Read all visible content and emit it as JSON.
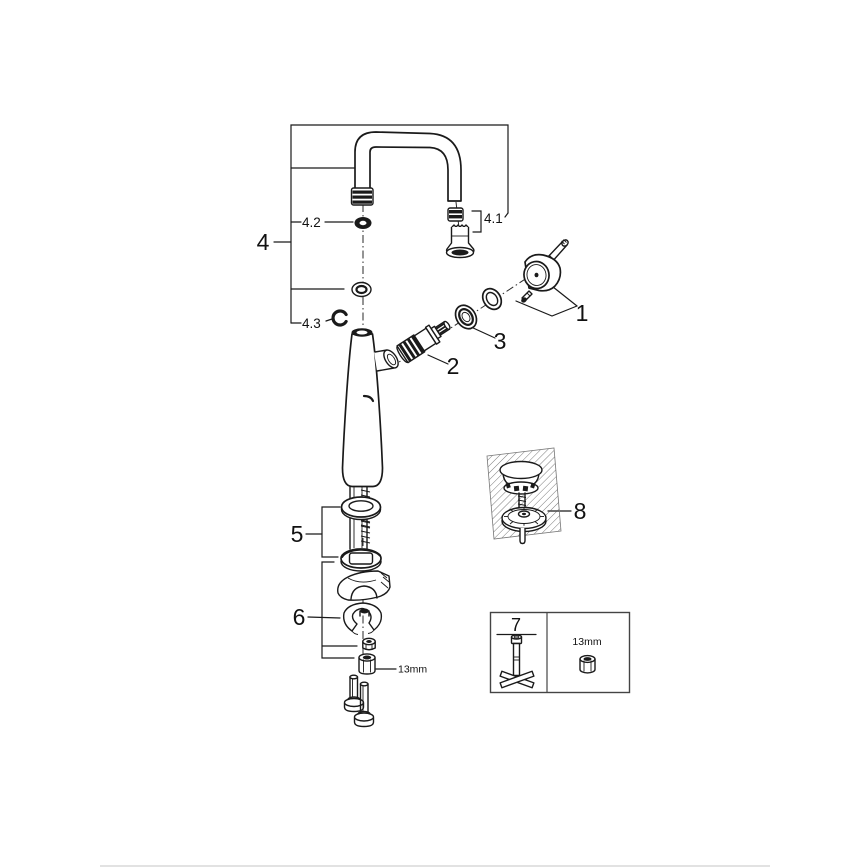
{
  "canvas": {
    "width": 868,
    "height": 868,
    "background": "#ffffff",
    "ink": "#1a1a1a",
    "divider_color": "#d9d9d9"
  },
  "callouts": {
    "n1": "1",
    "n2": "2",
    "n3": "3",
    "n4": "4",
    "n4_1": "4.1",
    "n4_2": "4.2",
    "n4_3": "4.3",
    "n5": "5",
    "n6": "6",
    "n7": "7",
    "n8": "8"
  },
  "annotations": {
    "nut_size": "13mm",
    "box_nut_size": "13mm"
  },
  "legend": [
    {
      "callout": "1",
      "part": "lever-handle-with-set-screw"
    },
    {
      "callout": "2",
      "part": "ceramic-cartridge"
    },
    {
      "callout": "3",
      "part": "cartridge-cap-ring-set"
    },
    {
      "callout": "4",
      "part": "swivel-u-spout"
    },
    {
      "callout": "4.1",
      "part": "aerator-mousseur"
    },
    {
      "callout": "4.2",
      "part": "spout-o-ring"
    },
    {
      "callout": "4.3",
      "part": "retaining-clip"
    },
    {
      "callout": "5",
      "part": "shank-seal-and-washer-set"
    },
    {
      "callout": "6",
      "part": "mounting-hardware-set"
    },
    {
      "callout": "7",
      "part": "socket-wrench-tool-box"
    },
    {
      "callout": "8",
      "part": "drain-plug-in-counter"
    }
  ]
}
